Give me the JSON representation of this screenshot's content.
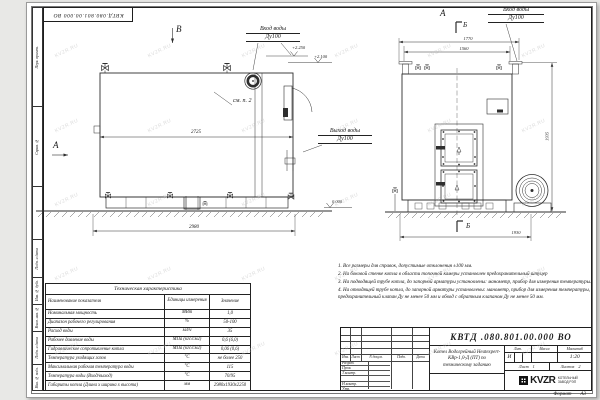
{
  "watermark": "KVZR.RU",
  "frame": {
    "corner_stamp": "КВТД.080.801.00.000 ВО",
    "side_columns": [
      "Перв. примен.",
      "Справ. №",
      "Подп. и дата",
      "Инв. № дубл.",
      "Взам. инв. №",
      "Подп. и дата",
      "Инв. № подл."
    ],
    "format_label": "Формат",
    "format_value": "А3"
  },
  "views": {
    "view_b_label": "В",
    "view_a_label": "А",
    "view_a_top_label": "А",
    "section_b_top": "Б",
    "section_b_bottom": "Б",
    "inlet_left_line1": "Вход воды",
    "inlet_left_line2": "Ду100",
    "outlet_line1": "Выход воды",
    "outlet_line2": "Ду100",
    "inlet_right_line1": "Вход воды",
    "inlet_right_line2": "Ду100",
    "callout_note2": "см. п. 2",
    "elev_top": "+2.250",
    "elev_mid": "+2.100",
    "elev_zero": "0.000",
    "dim_body_length": "2725",
    "dim_total_length": "2980",
    "dim_top_1770": "1770",
    "dim_top_1560": "1560",
    "dim_height": "1935",
    "dim_width": "1930"
  },
  "notes": {
    "lines": [
      "1. Все размеры для справок, допустимые отклонения ±100 мм.",
      "2. На боковой стенке котла в области топочной камеры установлен предохранительный штуцер",
      "3. На подводящей трубе котла, до запорной арматуры установлены: манометр, прибор для измерения температуры.",
      "4. На отводящей трубе котла, до запорной арматуры установлены: манометр, прибор для измерения температуры, предохранительный клапан Ду не менее 50 мм и обвод с обратным клапаном Ду не менее 50 мм."
    ]
  },
  "spec_table": {
    "title": "Техническая характеристика",
    "columns": [
      "Наименование показателя",
      "Единицы измерения",
      "Значение"
    ],
    "rows": [
      [
        "Номинальная мощность",
        "МВт",
        "1,0"
      ],
      [
        "Диапазон рабочего регулирования",
        "%",
        "50-100"
      ],
      [
        "Расход воды",
        "м3/ч",
        "35"
      ],
      [
        "Рабочее давление воды",
        "МПа (кгс/см2)",
        "0,6 (6,0)"
      ],
      [
        "Гидравлическое сопротивление котла",
        "МПа (кгс/см2)",
        "0,06 (0,6)"
      ],
      [
        "Температура уходящих газов",
        "°С",
        "не более 250"
      ],
      [
        "Максимальная рабочая температура воды",
        "°С",
        "115"
      ],
      [
        "Температура воды (Вход/выход)",
        "°С",
        "70/95"
      ],
      [
        "Габариты котла (Длина х ширина х высота)",
        "мм",
        "2980х1930х2250"
      ]
    ]
  },
  "title_block": {
    "doc_number": "КВТД .080.801.00.000 ВО",
    "description": "Котел Водогрейный Heatexpert-КВр-1,0-Д (ПТ) по техническому заданию",
    "rev_headers": [
      "Изм.",
      "Лист",
      "N докум.",
      "Подп.",
      "Дата"
    ],
    "sign_rows": [
      "Разраб.",
      "Пров.",
      "Т.контр.",
      "",
      "Н.контр.",
      "Утв."
    ],
    "lit_label": "Лит.",
    "lit_value": "И",
    "mass_label": "Масса",
    "scale_label": "Масштаб",
    "scale_value": "1:20",
    "sheet_label": "Лист",
    "sheet_value": "1",
    "sheets_label": "Листов",
    "sheets_value": "2",
    "logo": "KVZR",
    "company_line1": "КОТЕЛЬНЫЙ",
    "company_line2": "ЗАВОД РЭП"
  }
}
